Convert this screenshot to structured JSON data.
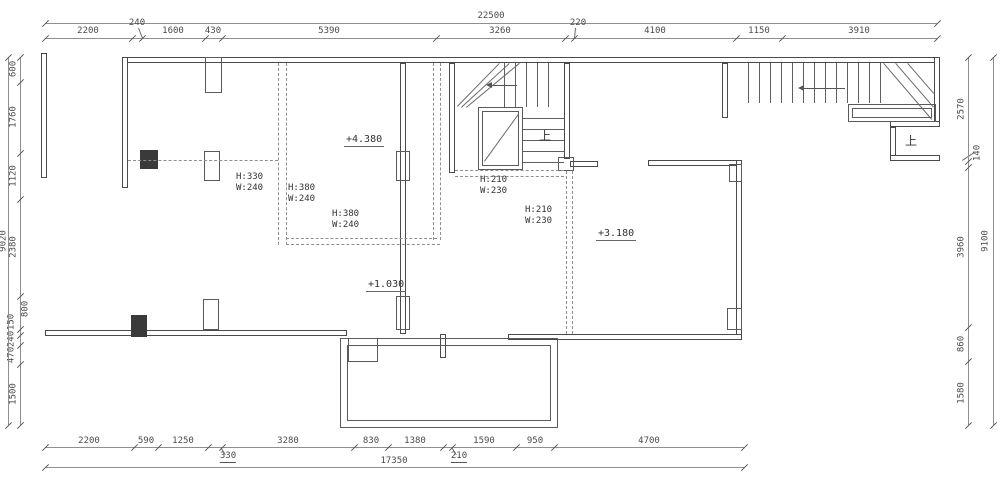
{
  "drawing_type": "architectural floor plan (CAD)",
  "colors": {
    "background": "#ffffff",
    "wall_line": "#4a4a4a",
    "dimension_line": "#8f8f8f",
    "dimension_text": "#4a4a4a",
    "dashed_beam_line": "#8f8f8f",
    "annotation_text": "#333333"
  },
  "dims": {
    "top": {
      "overall": {
        "o": "h",
        "x": 45,
        "y": 23,
        "len": 892,
        "ticks": [
          45,
          937
        ],
        "labels": [
          {
            "t": "22500",
            "x": 491,
            "y": 12
          }
        ]
      },
      "segments": {
        "o": "h",
        "x": 45,
        "y": 38,
        "len": 892,
        "ticks": [
          45,
          132,
          142,
          205,
          222,
          436,
          565,
          574,
          736,
          782,
          937
        ],
        "labels": [
          {
            "t": "2200",
            "x": 88,
            "y": 27
          },
          {
            "t": "240",
            "x": 137,
            "y": 19
          },
          {
            "t": "1600",
            "x": 173,
            "y": 27
          },
          {
            "t": "430",
            "x": 213,
            "y": 27
          },
          {
            "t": "5390",
            "x": 329,
            "y": 27
          },
          {
            "t": "3260",
            "x": 500,
            "y": 27
          },
          {
            "t": "220",
            "x": 578,
            "y": 19
          },
          {
            "t": "4100",
            "x": 655,
            "y": 27
          },
          {
            "t": "1150",
            "x": 759,
            "y": 27
          },
          {
            "t": "3910",
            "x": 859,
            "y": 27
          }
        ]
      }
    },
    "bottom": {
      "segments": {
        "o": "h",
        "x": 45,
        "y": 447,
        "len": 699,
        "ticks": [
          45,
          134,
          158,
          208,
          222,
          354,
          388,
          443,
          452,
          516,
          554,
          744
        ],
        "labels": [
          {
            "t": "2200",
            "x": 89,
            "y": 437
          },
          {
            "t": "590",
            "x": 146,
            "y": 437
          },
          {
            "t": "1250",
            "x": 183,
            "y": 437
          },
          {
            "t": "330",
            "x": 228,
            "y": 452,
            "u": 1
          },
          {
            "t": "3280",
            "x": 288,
            "y": 437
          },
          {
            "t": "830",
            "x": 371,
            "y": 437
          },
          {
            "t": "1380",
            "x": 415,
            "y": 437
          },
          {
            "t": "210",
            "x": 459,
            "y": 452,
            "u": 1
          },
          {
            "t": "1590",
            "x": 484,
            "y": 437
          },
          {
            "t": "950",
            "x": 535,
            "y": 437
          },
          {
            "t": "4700",
            "x": 649,
            "y": 437
          }
        ]
      },
      "overall": {
        "o": "h",
        "x": 45,
        "y": 467,
        "len": 699,
        "ticks": [
          45,
          744
        ],
        "labels": [
          {
            "t": "17350",
            "x": 394,
            "y": 457
          }
        ]
      }
    },
    "left": {
      "segments": {
        "o": "v",
        "x": 20,
        "y": 57,
        "len": 368,
        "ticks": [
          57,
          82,
          153,
          199,
          296,
          329,
          335,
          345,
          364,
          425
        ],
        "labels": [
          {
            "t": "600",
            "x": 14,
            "y": 69,
            "r": 1
          },
          {
            "t": "1760",
            "x": 14,
            "y": 117,
            "r": 1
          },
          {
            "t": "1120",
            "x": 14,
            "y": 176,
            "r": 1
          },
          {
            "t": "2380",
            "x": 14,
            "y": 247,
            "r": 1
          },
          {
            "t": "800",
            "x": 26,
            "y": 309,
            "r": 1
          },
          {
            "t": "150",
            "x": 12,
            "y": 322,
            "r": 1
          },
          {
            "t": "240",
            "x": 12,
            "y": 339,
            "r": 1
          },
          {
            "t": "470",
            "x": 12,
            "y": 355,
            "r": 1
          },
          {
            "t": "1500",
            "x": 14,
            "y": 394,
            "r": 1
          }
        ]
      },
      "overall": {
        "o": "v",
        "x": 8,
        "y": 57,
        "len": 368,
        "ticks": [
          57,
          425
        ],
        "labels": [
          {
            "t": "9020",
            "x": 4,
            "y": 241,
            "r": 1
          }
        ]
      }
    },
    "right": {
      "segments": {
        "o": "v",
        "x": 968,
        "y": 57,
        "len": 368,
        "ticks": [
          57,
          161,
          167,
          327,
          361,
          425
        ],
        "labels": [
          {
            "t": "2570",
            "x": 962,
            "y": 109,
            "r": 1
          },
          {
            "t": "140",
            "x": 978,
            "y": 153,
            "r": 1
          },
          {
            "t": "3960",
            "x": 962,
            "y": 247,
            "r": 1
          },
          {
            "t": "860",
            "x": 962,
            "y": 344,
            "r": 1
          },
          {
            "t": "1580",
            "x": 962,
            "y": 393,
            "r": 1
          }
        ]
      },
      "overall": {
        "o": "v",
        "x": 993,
        "y": 57,
        "len": 368,
        "ticks": [
          57,
          425
        ],
        "labels": [
          {
            "t": "9100",
            "x": 986,
            "y": 241,
            "r": 1
          }
        ]
      }
    }
  },
  "annotations": {
    "levels": [
      {
        "t": "+4.380",
        "x": 344,
        "y": 134
      },
      {
        "t": "+1.030",
        "x": 366,
        "y": 279
      },
      {
        "t": "+3.180",
        "x": 596,
        "y": 228
      }
    ],
    "beams": [
      {
        "l1": "H:330",
        "l2": "W:240",
        "x": 236,
        "y": 172
      },
      {
        "l1": "H:380",
        "l2": "W:240",
        "x": 288,
        "y": 183
      },
      {
        "l1": "H:380",
        "l2": "W:240",
        "x": 332,
        "y": 209
      },
      {
        "l1": "H:210",
        "l2": "W:230",
        "x": 480,
        "y": 175
      },
      {
        "l1": "H:210",
        "l2": "W:230",
        "x": 525,
        "y": 205
      }
    ],
    "up_labels": [
      {
        "t": "上",
        "x": 539,
        "y": 130
      },
      {
        "t": "上",
        "x": 905,
        "y": 135
      }
    ]
  },
  "geometry": {
    "walls": [
      [
        122,
        57,
        818,
        6
      ],
      [
        41,
        53,
        6,
        125
      ],
      [
        122,
        57,
        6,
        131
      ],
      [
        400,
        63,
        6,
        271
      ],
      [
        449,
        63,
        6,
        110
      ],
      [
        564,
        63,
        6,
        96
      ],
      [
        570,
        161,
        28,
        6
      ],
      [
        648,
        160,
        94,
        6
      ],
      [
        736,
        160,
        6,
        180
      ],
      [
        508,
        334,
        234,
        6
      ],
      [
        45,
        330,
        302,
        6
      ],
      [
        722,
        63,
        6,
        55
      ],
      [
        934,
        57,
        6,
        67
      ],
      [
        890,
        121,
        50,
        6
      ],
      [
        890,
        127,
        6,
        34
      ],
      [
        890,
        155,
        50,
        6
      ],
      [
        440,
        334,
        6,
        24
      ]
    ],
    "outlines": [
      [
        340,
        338,
        218,
        90
      ],
      [
        347,
        345,
        204,
        76
      ],
      [
        348,
        338,
        30,
        24
      ],
      [
        478,
        107,
        45,
        63
      ],
      [
        482,
        111,
        37,
        55
      ],
      [
        848,
        104,
        88,
        18
      ],
      [
        852,
        108,
        80,
        10
      ],
      [
        204,
        151,
        16,
        30
      ],
      [
        396,
        151,
        14,
        30
      ],
      [
        205,
        57,
        17,
        36
      ],
      [
        203,
        299,
        16,
        31
      ],
      [
        396,
        296,
        14,
        34
      ],
      [
        558,
        157,
        16,
        14
      ],
      [
        727,
        308,
        15,
        22
      ],
      [
        729,
        164,
        13,
        18
      ]
    ],
    "filled": [
      [
        140,
        150,
        18,
        19
      ],
      [
        131,
        315,
        16,
        22
      ]
    ],
    "vlines": [
      [
        504,
        63,
        44
      ],
      [
        515,
        63,
        44
      ],
      [
        526,
        63,
        44
      ],
      [
        537,
        63,
        44
      ],
      [
        548,
        63,
        44
      ],
      [
        748,
        63,
        40
      ],
      [
        759,
        63,
        40
      ],
      [
        770,
        63,
        40
      ],
      [
        781,
        63,
        40
      ],
      [
        792,
        63,
        40
      ],
      [
        803,
        63,
        40
      ],
      [
        814,
        63,
        40
      ],
      [
        825,
        63,
        40
      ],
      [
        836,
        63,
        40
      ],
      [
        847,
        63,
        40
      ],
      [
        858,
        63,
        40
      ],
      [
        869,
        63,
        40
      ],
      [
        880,
        63,
        40
      ]
    ],
    "hlines": [
      [
        523,
        118,
        41
      ],
      [
        523,
        129,
        41
      ],
      [
        523,
        140,
        41
      ],
      [
        523,
        151,
        41
      ],
      [
        523,
        162,
        41
      ]
    ],
    "dvlines": [
      [
        278,
        63,
        182
      ],
      [
        286,
        63,
        182
      ],
      [
        433,
        63,
        177
      ],
      [
        440,
        63,
        177
      ],
      [
        566,
        171,
        163
      ],
      [
        572,
        171,
        163
      ]
    ],
    "dhlines": [
      [
        128,
        160,
        150
      ],
      [
        286,
        238,
        151
      ],
      [
        286,
        244,
        154
      ],
      [
        455,
        170,
        109
      ],
      [
        455,
        176,
        109
      ]
    ],
    "diagonals": [
      [
        457,
        106,
        499,
        63
      ],
      [
        461,
        107,
        509,
        63
      ],
      [
        466,
        107,
        519,
        63
      ],
      [
        484,
        161,
        518,
        114
      ],
      [
        884,
        63,
        932,
        119
      ],
      [
        896,
        63,
        934,
        107
      ],
      [
        908,
        63,
        934,
        93
      ],
      [
        139,
        28,
        143,
        38
      ],
      [
        576,
        28,
        575,
        38
      ],
      [
        221,
        447,
        226,
        455
      ],
      [
        452,
        447,
        457,
        455
      ],
      [
        962,
        160,
        974,
        152
      ]
    ],
    "arrows": [
      [
        488,
        85,
        517
      ],
      [
        800,
        88,
        845
      ]
    ]
  }
}
